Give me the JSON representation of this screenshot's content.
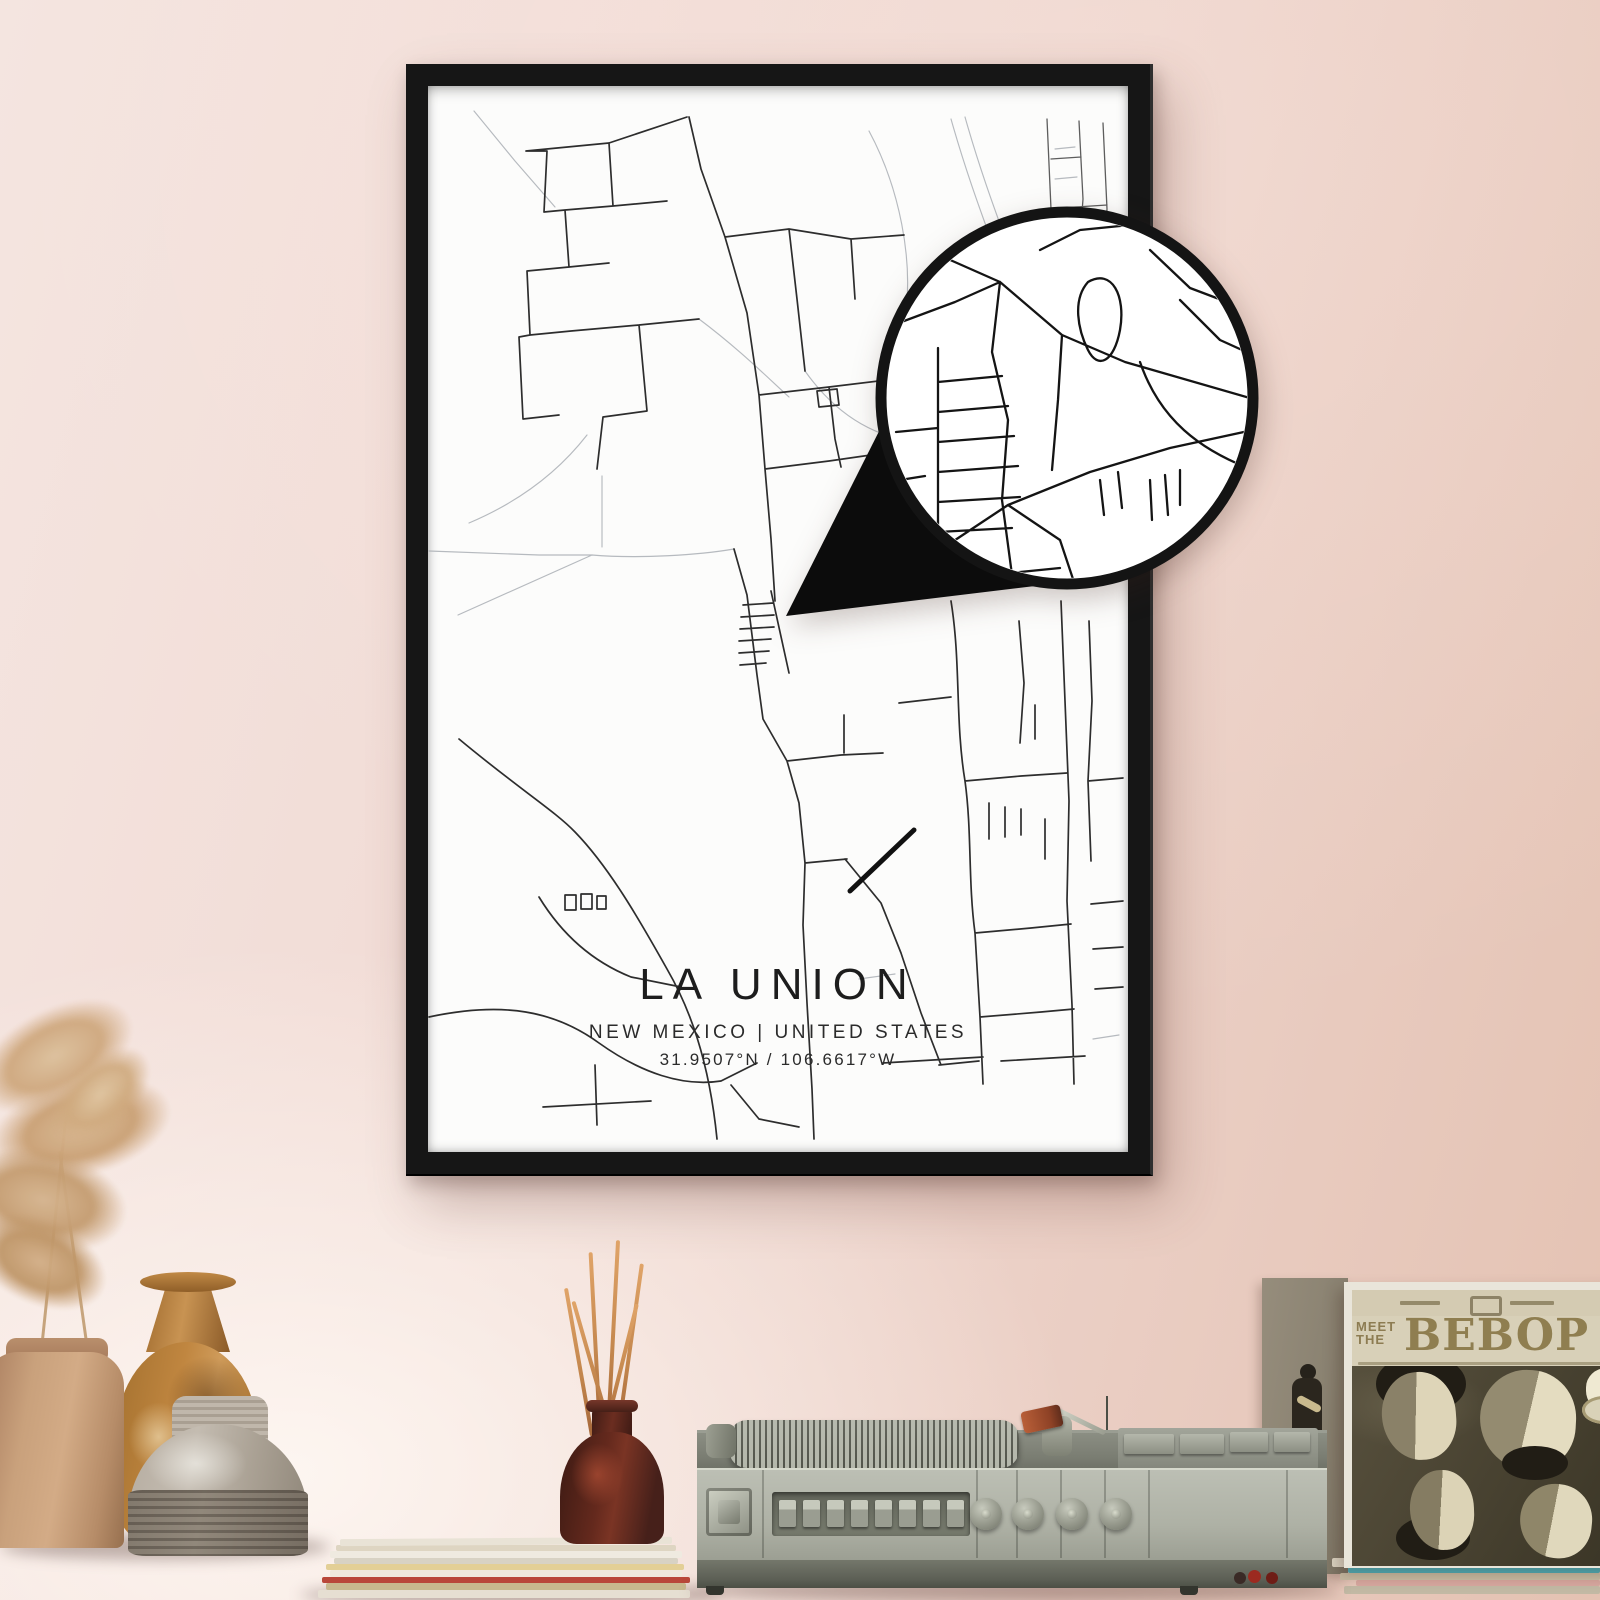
{
  "poster": {
    "title": "LA UNION",
    "subtitle": "NEW MEXICO | UNITED STATES",
    "coordinates": "31.9507°N / 106.6617°W"
  },
  "album": {
    "meet": "MEET",
    "the": "THE",
    "bebop": "BEBOP"
  },
  "palette": {
    "wall_pink": "#eed5cd",
    "frame_black": "#161616",
    "poster_white": "#fcfcfb",
    "road_primary": "#2d2d2d",
    "road_secondary": "#a9aeb4",
    "table_wood": "#8d5639",
    "album_ink": "#8d7c52",
    "diffuser_brown": "#64291d",
    "reed_orange": "#d9a066"
  }
}
